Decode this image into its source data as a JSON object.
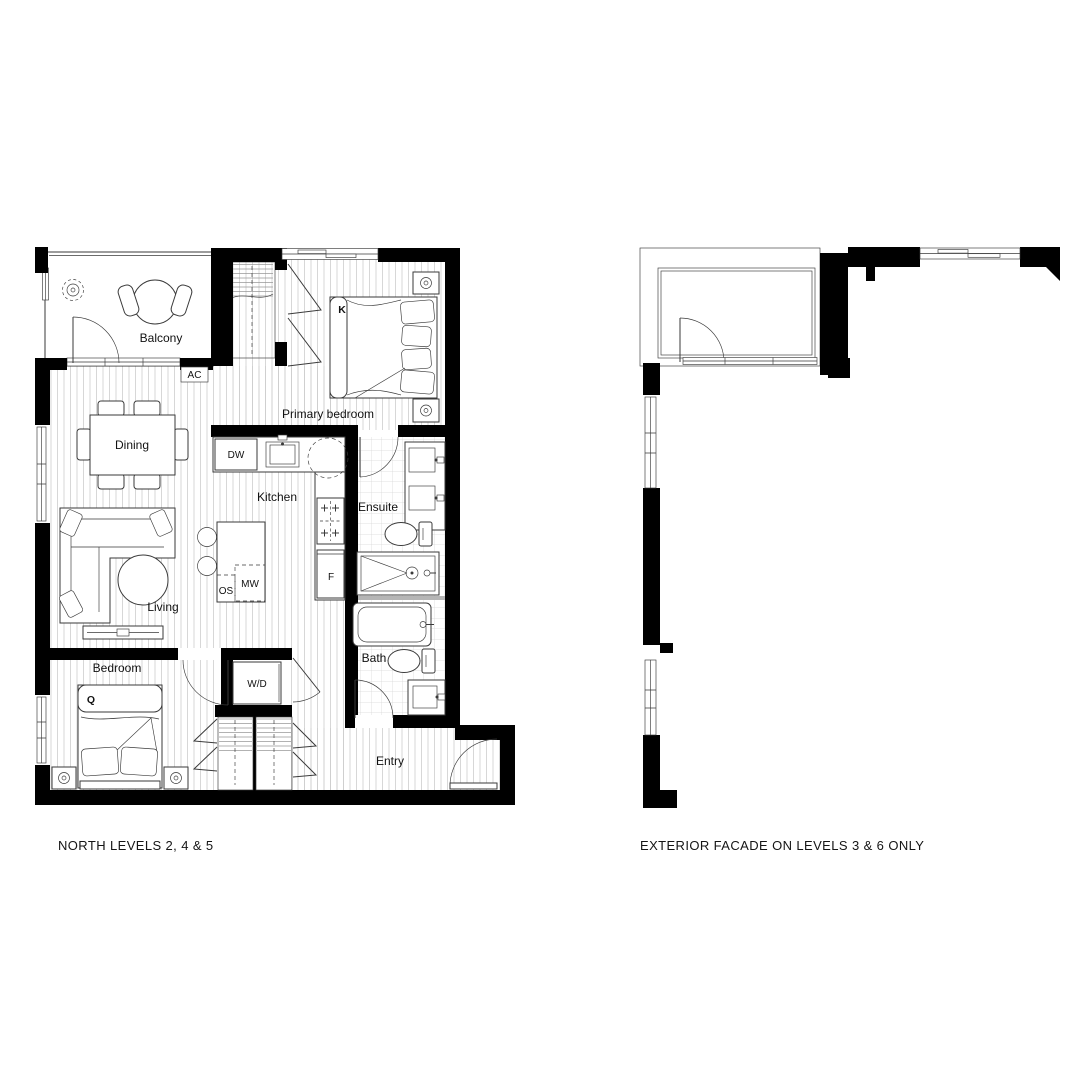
{
  "left_plan": {
    "caption": "NORTH LEVELS 2, 4 & 5",
    "rooms": {
      "balcony": "Balcony",
      "primary_bedroom": "Primary bedroom",
      "dining": "Dining",
      "kitchen": "Kitchen",
      "ensuite": "Ensuite",
      "living": "Living",
      "bedroom": "Bedroom",
      "bath": "Bath",
      "entry": "Entry"
    },
    "fixtures": {
      "ac": "AC",
      "dishwasher": "DW",
      "microwave": "MW",
      "oven_stove": "OS",
      "fridge": "F",
      "washer_dryer": "W/D"
    },
    "beds": {
      "king": "K",
      "queen": "Q"
    }
  },
  "right_plan": {
    "caption": "EXTERIOR FACADE ON LEVELS 3 & 6 ONLY"
  },
  "colors": {
    "walls": "#000000",
    "linework": "#3a3a3a",
    "floor_hatch": "#cccccc",
    "tile_hatch": "#d8d8d8",
    "text": "#111111",
    "background": "#ffffff"
  }
}
